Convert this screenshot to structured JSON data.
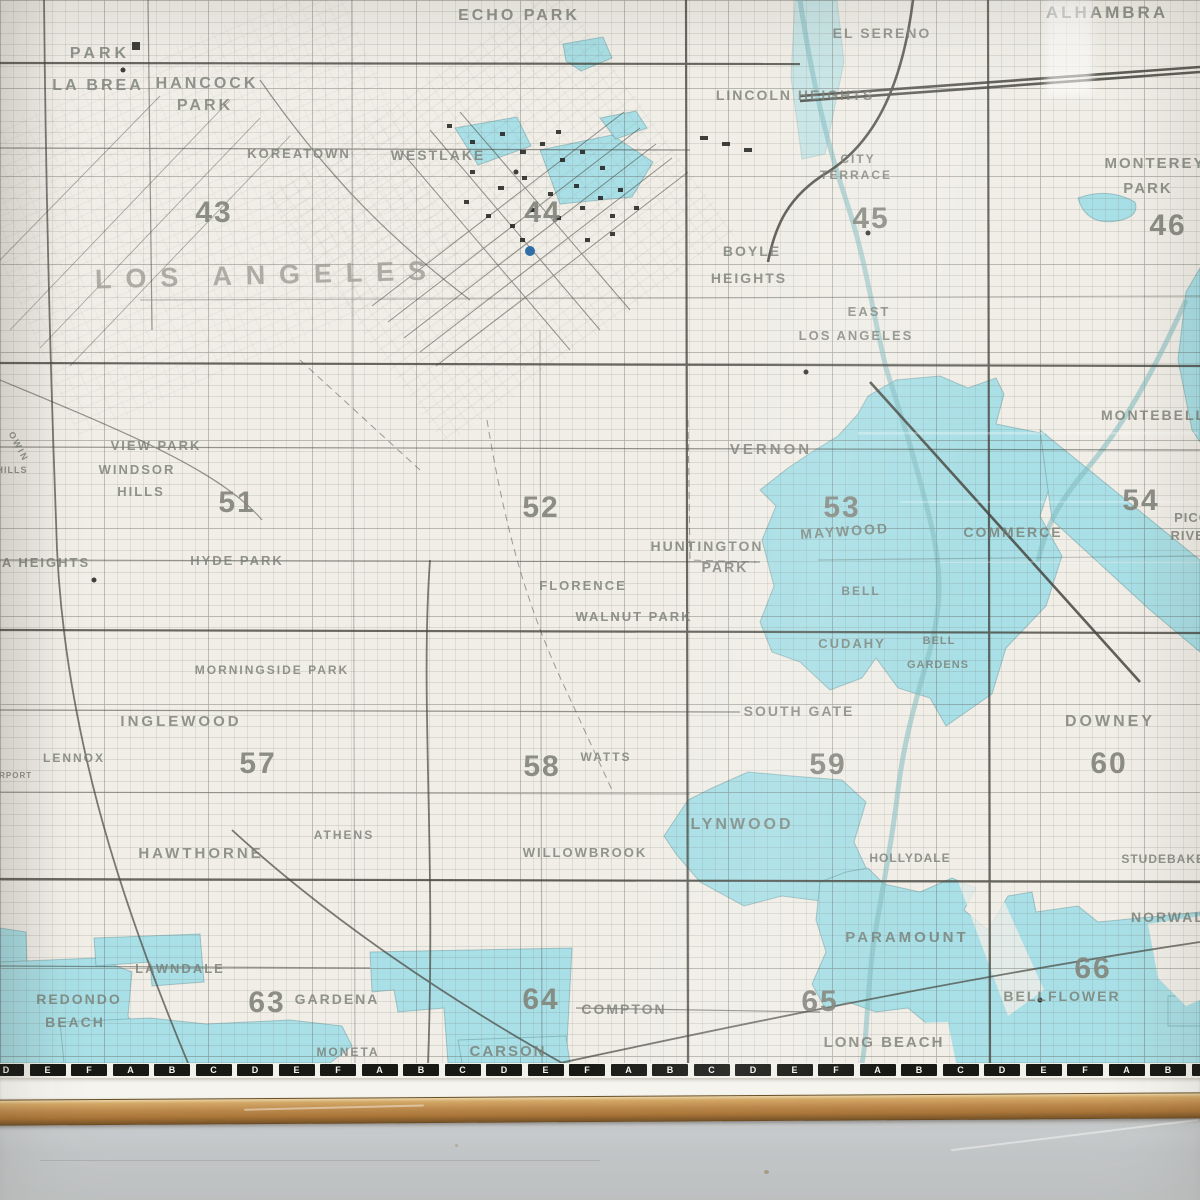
{
  "photo": {
    "description": "Framed Los Angeles wall street-map, lower-right portion, hung above a gray wall",
    "colors": {
      "paper": "#f0eee7",
      "incorporated_city_cyan": "#a9dfe6",
      "road_ink": "#46463f",
      "label_gray": "#787c73",
      "grid_number_gray": "#84867d",
      "ruler_black": "#181815",
      "margin_white": "#f5f4ef",
      "wood_frame": "#bd8a4e",
      "wall_gray": "#c7cacc",
      "water_dot_blue": "#2f6fa5"
    },
    "big_label": "LOS ANGELES",
    "place_labels": [
      {
        "text": "PARK",
        "x": 100,
        "y": 58,
        "fs": 16,
        "ls": 4
      },
      {
        "text": "LA BREA",
        "x": 98,
        "y": 90,
        "fs": 16,
        "ls": 3
      },
      {
        "text": "HANCOCK",
        "x": 207,
        "y": 88,
        "fs": 16,
        "ls": 3
      },
      {
        "text": "PARK",
        "x": 205,
        "y": 110,
        "fs": 16,
        "ls": 3
      },
      {
        "text": "KOREATOWN",
        "x": 299,
        "y": 158,
        "fs": 13,
        "ls": 2
      },
      {
        "text": "WESTLAKE",
        "x": 438,
        "y": 160,
        "fs": 14,
        "ls": 2
      },
      {
        "text": "ECHO PARK",
        "x": 519,
        "y": 20,
        "fs": 16,
        "ls": 3
      },
      {
        "text": "LINCOLN HEIGHTS",
        "x": 795,
        "y": 100,
        "fs": 14,
        "ls": 2
      },
      {
        "text": "EL SERENO",
        "x": 882,
        "y": 38,
        "fs": 14,
        "ls": 2
      },
      {
        "text": "ALHAMBRA",
        "x": 1107,
        "y": 18,
        "fs": 17,
        "ls": 3
      },
      {
        "text": "CITY",
        "x": 858,
        "y": 163,
        "fs": 12,
        "ls": 2
      },
      {
        "text": "TERRACE",
        "x": 856,
        "y": 179,
        "fs": 12,
        "ls": 2
      },
      {
        "text": "MONTEREY",
        "x": 1155,
        "y": 168,
        "fs": 15,
        "ls": 2
      },
      {
        "text": "PARK",
        "x": 1148,
        "y": 193,
        "fs": 15,
        "ls": 2
      },
      {
        "text": "BOYLE",
        "x": 752,
        "y": 256,
        "fs": 14,
        "ls": 2
      },
      {
        "text": "HEIGHTS",
        "x": 749,
        "y": 283,
        "fs": 14,
        "ls": 2
      },
      {
        "text": "EAST",
        "x": 869,
        "y": 316,
        "fs": 13,
        "ls": 2
      },
      {
        "text": "LOS ANGELES",
        "x": 856,
        "y": 340,
        "fs": 13,
        "ls": 2
      },
      {
        "text": "MONTEBELLO",
        "x": 1160,
        "y": 420,
        "fs": 14,
        "ls": 2
      },
      {
        "text": "VERNON",
        "x": 771,
        "y": 454,
        "fs": 15,
        "ls": 3
      },
      {
        "text": "MAYWOOD",
        "x": 845,
        "y": 536,
        "fs": 14,
        "ls": 2,
        "rot": -4
      },
      {
        "text": "COMMERCE",
        "x": 1013,
        "y": 537,
        "fs": 14,
        "ls": 2
      },
      {
        "text": "PICO",
        "x": 1192,
        "y": 522,
        "fs": 13,
        "ls": 1
      },
      {
        "text": "RIVERA",
        "x": 1198,
        "y": 540,
        "fs": 13,
        "ls": 1
      },
      {
        "text": "HUNTINGTON",
        "x": 707,
        "y": 551,
        "fs": 14,
        "ls": 2
      },
      {
        "text": "PARK",
        "x": 725,
        "y": 572,
        "fs": 14,
        "ls": 2
      },
      {
        "text": "FLORENCE",
        "x": 583,
        "y": 590,
        "fs": 13,
        "ls": 2
      },
      {
        "text": "WALNUT PARK",
        "x": 634,
        "y": 621,
        "fs": 13,
        "ls": 2
      },
      {
        "text": "BELL",
        "x": 861,
        "y": 595,
        "fs": 12,
        "ls": 2
      },
      {
        "text": "CUDAHY",
        "x": 852,
        "y": 648,
        "fs": 13,
        "ls": 2
      },
      {
        "text": "BELL",
        "x": 939,
        "y": 644,
        "fs": 11,
        "ls": 1
      },
      {
        "text": "GARDENS",
        "x": 938,
        "y": 668,
        "fs": 11,
        "ls": 1
      },
      {
        "text": "VIEW PARK",
        "x": 156,
        "y": 450,
        "fs": 13,
        "ls": 2
      },
      {
        "text": "WINDSOR",
        "x": 137,
        "y": 474,
        "fs": 13,
        "ls": 2
      },
      {
        "text": "HILLS",
        "x": 141,
        "y": 496,
        "fs": 13,
        "ls": 2
      },
      {
        "text": "OWIN",
        "x": 16,
        "y": 448,
        "fs": 9,
        "ls": 2,
        "rot": 62
      },
      {
        "text": "HILLS",
        "x": 12,
        "y": 473,
        "fs": 9,
        "ls": 1
      },
      {
        "text": "A HEIGHTS",
        "x": 46,
        "y": 567,
        "fs": 13,
        "ls": 2
      },
      {
        "text": "HYDE PARK",
        "x": 237,
        "y": 565,
        "fs": 13,
        "ls": 2
      },
      {
        "text": "MORNINGSIDE PARK",
        "x": 272,
        "y": 674,
        "fs": 12,
        "ls": 2
      },
      {
        "text": "INGLEWOOD",
        "x": 181,
        "y": 726,
        "fs": 15,
        "ls": 3
      },
      {
        "text": "LENNOX",
        "x": 74,
        "y": 762,
        "fs": 12,
        "ls": 2
      },
      {
        "text": "IRPORT",
        "x": 14,
        "y": 778,
        "fs": 8,
        "ls": 1
      },
      {
        "text": "SOUTH GATE",
        "x": 799,
        "y": 716,
        "fs": 14,
        "ls": 2
      },
      {
        "text": "DOWNEY",
        "x": 1110,
        "y": 726,
        "fs": 16,
        "ls": 3
      },
      {
        "text": "WATTS",
        "x": 606,
        "y": 761,
        "fs": 12,
        "ls": 2
      },
      {
        "text": "ATHENS",
        "x": 344,
        "y": 839,
        "fs": 12,
        "ls": 2
      },
      {
        "text": "HAWTHORNE",
        "x": 201,
        "y": 858,
        "fs": 15,
        "ls": 3
      },
      {
        "text": "WILLOWBROOK",
        "x": 585,
        "y": 857,
        "fs": 13,
        "ls": 2
      },
      {
        "text": "LYNWOOD",
        "x": 742,
        "y": 829,
        "fs": 16,
        "ls": 3
      },
      {
        "text": "HOLLYDALE",
        "x": 910,
        "y": 862,
        "fs": 12,
        "ls": 1
      },
      {
        "text": "STUDEBAKER",
        "x": 1168,
        "y": 863,
        "fs": 12,
        "ls": 1
      },
      {
        "text": "PARAMOUNT",
        "x": 907,
        "y": 942,
        "fs": 15,
        "ls": 3
      },
      {
        "text": "NORWALK",
        "x": 1174,
        "y": 922,
        "fs": 14,
        "ls": 2
      },
      {
        "text": "LAWNDALE",
        "x": 180,
        "y": 973,
        "fs": 13,
        "ls": 2
      },
      {
        "text": "REDONDO",
        "x": 79,
        "y": 1004,
        "fs": 14,
        "ls": 2
      },
      {
        "text": "BEACH",
        "x": 75,
        "y": 1027,
        "fs": 14,
        "ls": 2
      },
      {
        "text": "GARDENA",
        "x": 337,
        "y": 1004,
        "fs": 14,
        "ls": 2
      },
      {
        "text": "MONETA",
        "x": 348,
        "y": 1056,
        "fs": 12,
        "ls": 2
      },
      {
        "text": "COMPTON",
        "x": 624,
        "y": 1014,
        "fs": 14,
        "ls": 2
      },
      {
        "text": "CARSON",
        "x": 508,
        "y": 1056,
        "fs": 15,
        "ls": 2
      },
      {
        "text": "BELLFLOWER",
        "x": 1062,
        "y": 1001,
        "fs": 14,
        "ls": 2
      },
      {
        "text": "LONG BEACH",
        "x": 884,
        "y": 1047,
        "fs": 15,
        "ls": 2
      }
    ],
    "grid_numbers": [
      {
        "n": "43",
        "x": 214,
        "y": 222
      },
      {
        "n": "44",
        "x": 543,
        "y": 222
      },
      {
        "n": "45",
        "x": 871,
        "y": 228
      },
      {
        "n": "46",
        "x": 1168,
        "y": 235
      },
      {
        "n": "51",
        "x": 237,
        "y": 512
      },
      {
        "n": "52",
        "x": 541,
        "y": 517
      },
      {
        "n": "53",
        "x": 842,
        "y": 517
      },
      {
        "n": "54",
        "x": 1141,
        "y": 510
      },
      {
        "n": "57",
        "x": 258,
        "y": 773
      },
      {
        "n": "58",
        "x": 542,
        "y": 776
      },
      {
        "n": "59",
        "x": 828,
        "y": 774
      },
      {
        "n": "60",
        "x": 1109,
        "y": 773
      },
      {
        "n": "63",
        "x": 267,
        "y": 1012
      },
      {
        "n": "64",
        "x": 541,
        "y": 1009
      },
      {
        "n": "65",
        "x": 820,
        "y": 1011
      },
      {
        "n": "66",
        "x": 1093,
        "y": 978
      }
    ],
    "ruler_letters": [
      "D",
      "E",
      "F",
      "A",
      "B",
      "C",
      "D",
      "E",
      "F",
      "A",
      "B",
      "C",
      "D",
      "E",
      "F",
      "A",
      "B",
      "C",
      "D",
      "E",
      "F",
      "A",
      "B",
      "C",
      "D",
      "E",
      "F",
      "A",
      "B",
      "C"
    ]
  }
}
